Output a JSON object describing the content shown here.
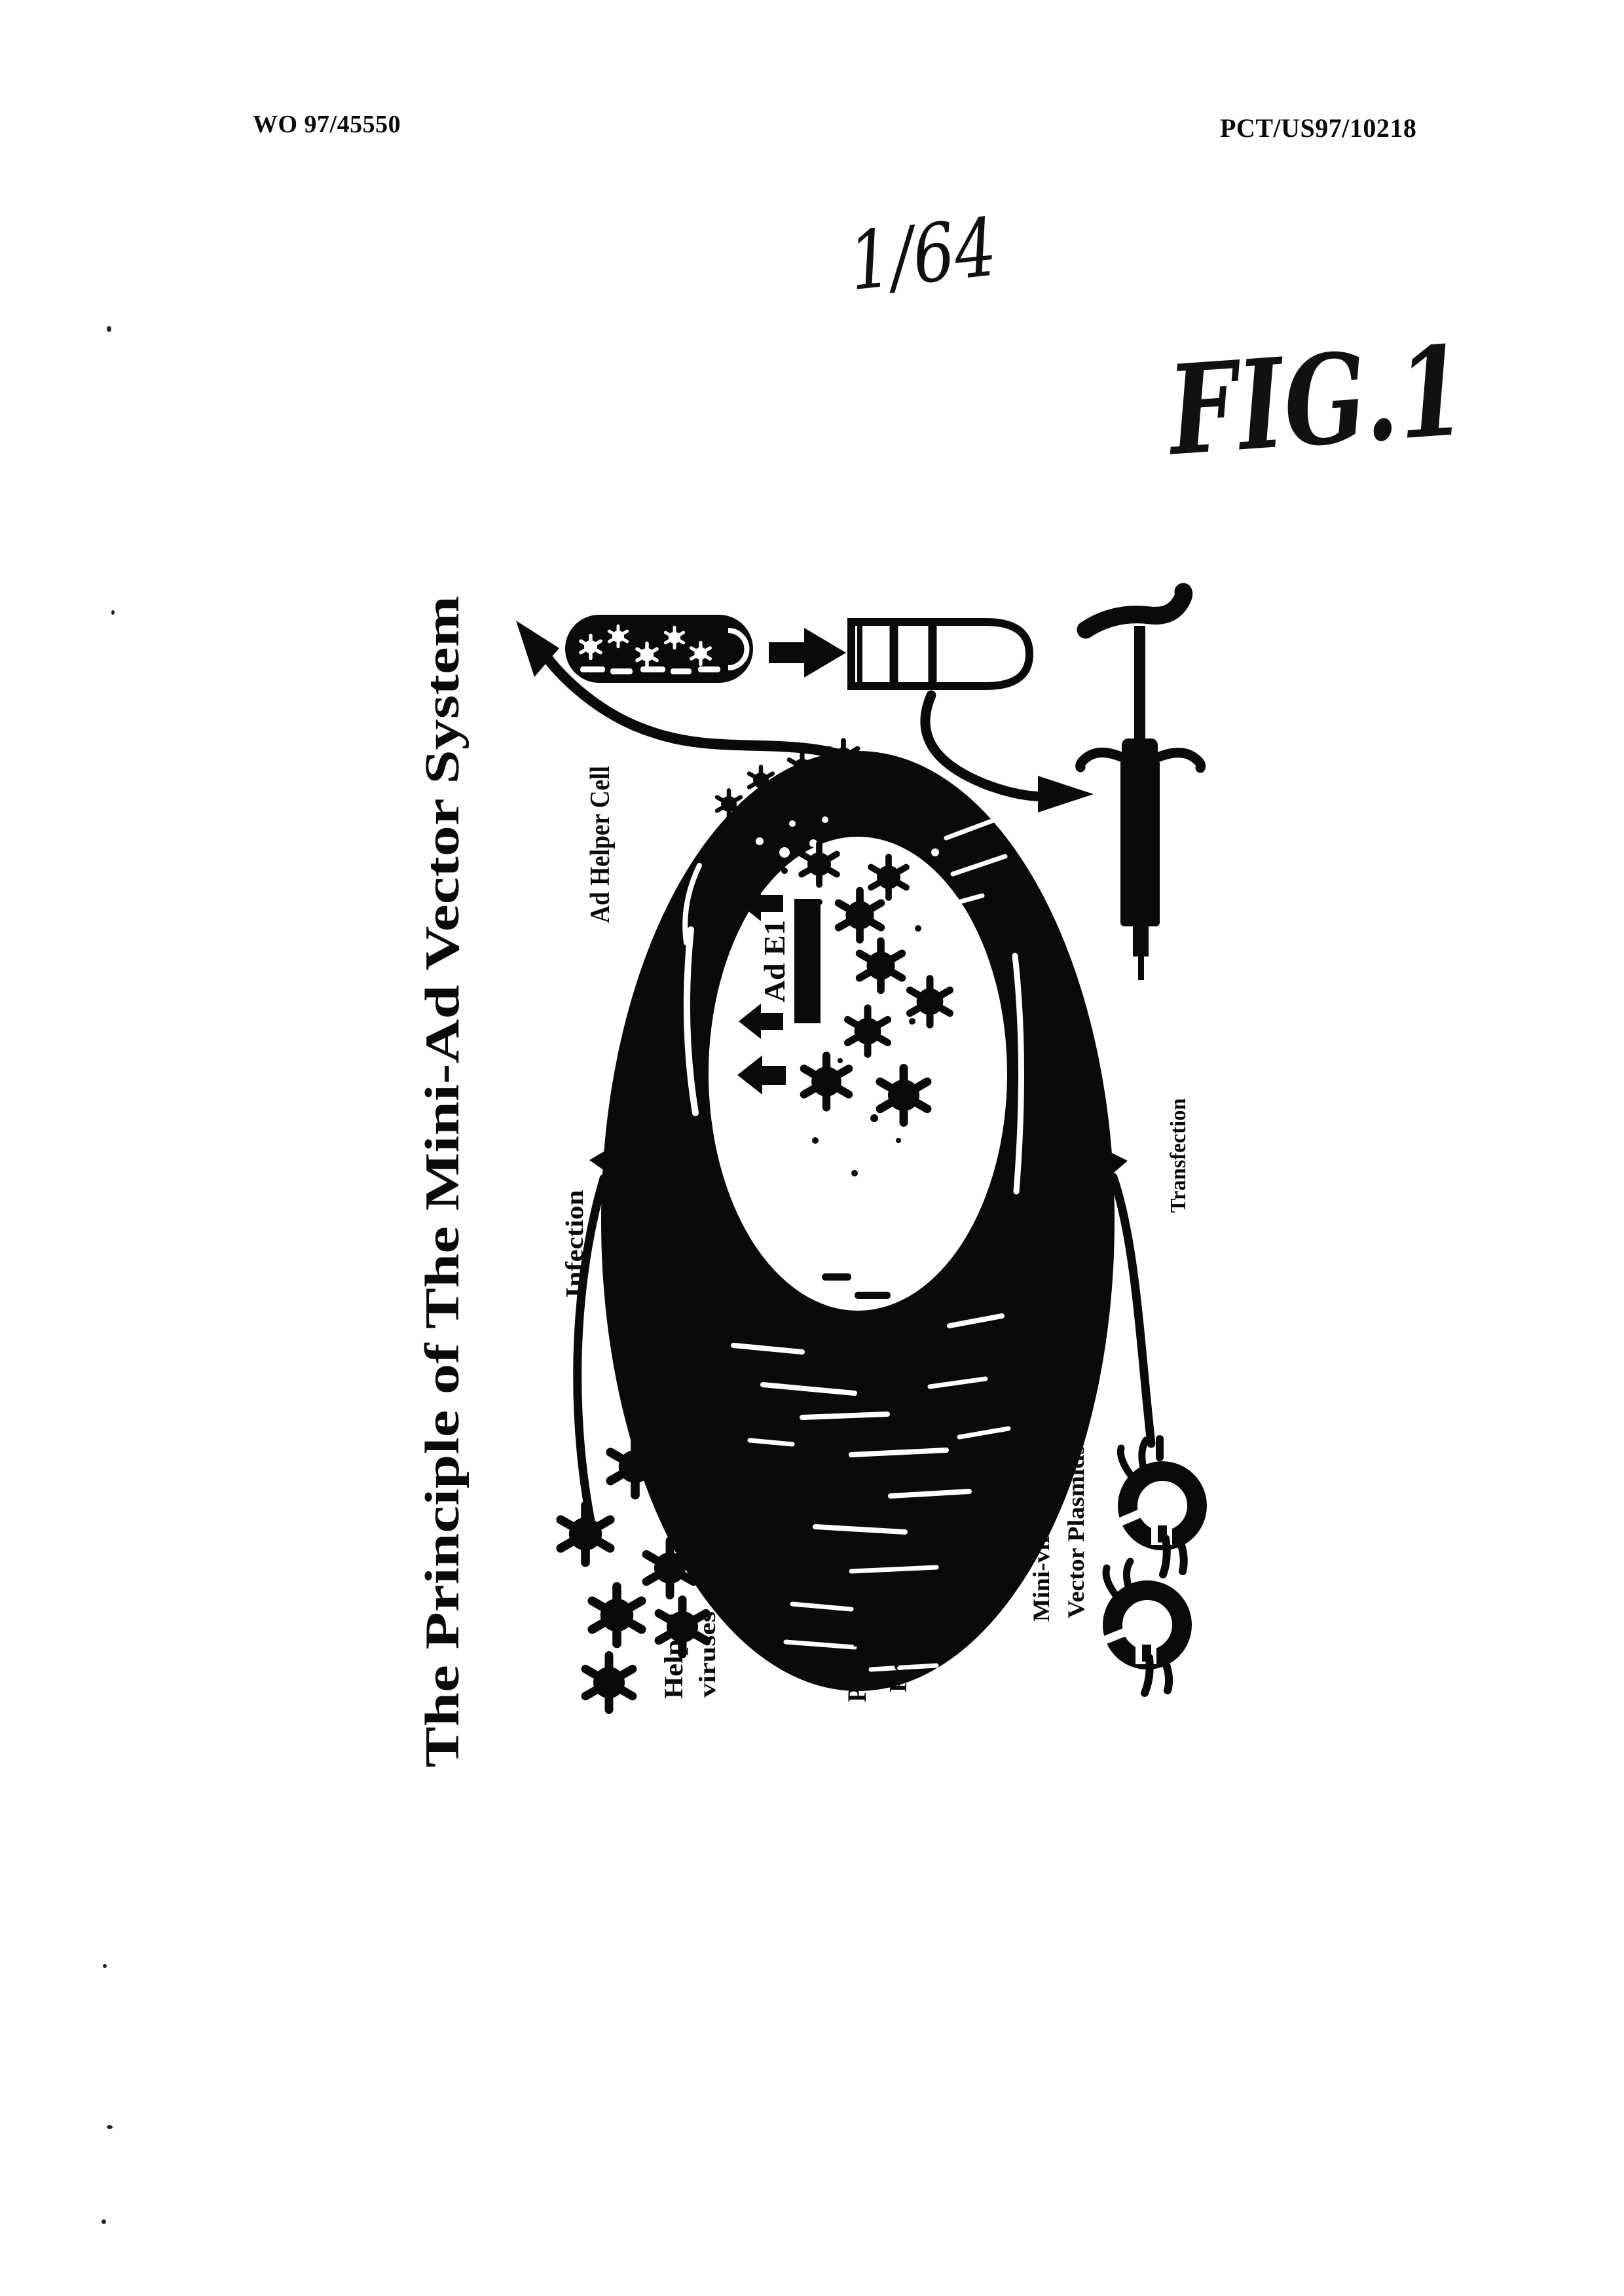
{
  "header": {
    "left": "WO 97/45550",
    "right": "PCT/US97/10218"
  },
  "sheet_number": "1/64",
  "figure_label": "FIG.1",
  "figure": {
    "title": "The Principle of The Mini-Ad Vector System",
    "labels": {
      "ad_helper_cell": "Ad Helper Cell",
      "ad_e1": "Ad E1",
      "infection": "Infection",
      "transfection": "Transfection",
      "helper_line1": "Helper",
      "helper_line2": "viruses",
      "packaging_line1": "Packaging",
      "packaging_line2": "Proteins",
      "plasmid_line1": "Mini-viral",
      "plasmid_line2": "Vector Plasmids"
    }
  },
  "colors": {
    "ink": "#0a0a0a",
    "paper": "#ffffff"
  }
}
